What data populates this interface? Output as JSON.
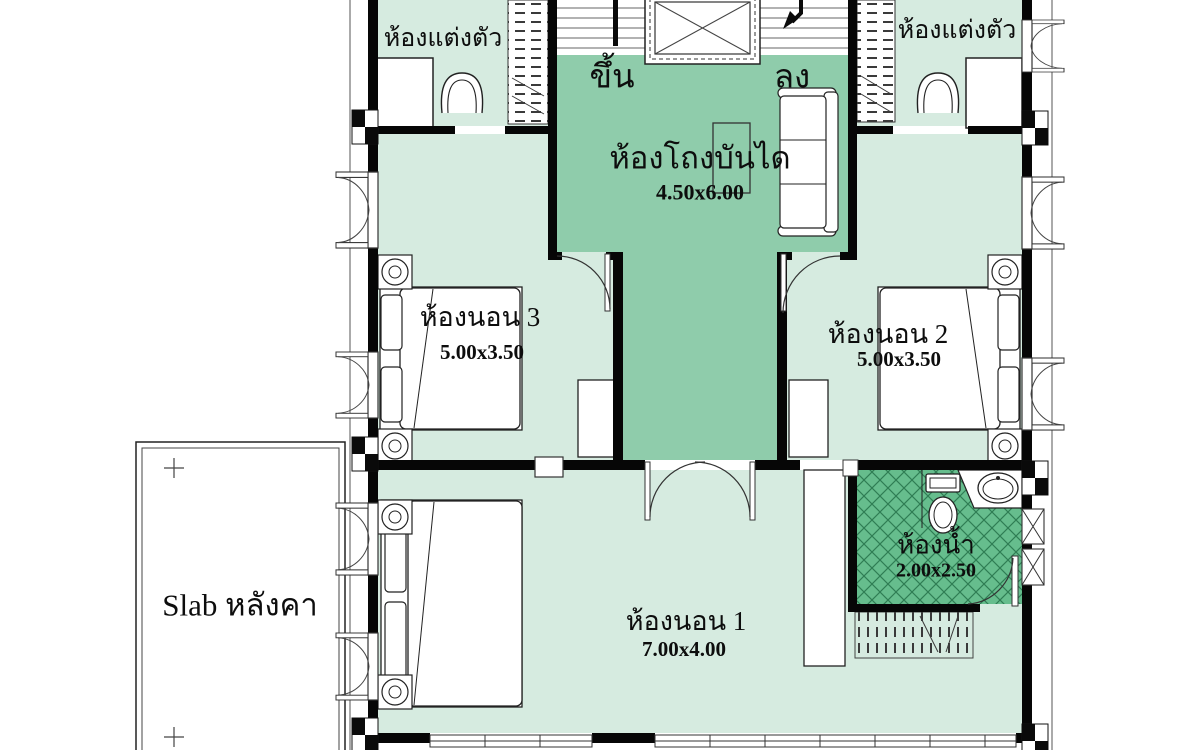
{
  "colors": {
    "room_light": "#d6ebe0",
    "hall_green": "#8fccab",
    "bath_green": "#66bd8d",
    "wall": "#060606",
    "hatch_line": "#2f7d54"
  },
  "stair_hall": {
    "label": "ห้องโถงบันได",
    "size": "4.50x6.00",
    "up_label": "ขึ้น",
    "down_label": "ลง"
  },
  "dressing_left": {
    "label": "ห้องแต่งตัว"
  },
  "dressing_right": {
    "label": "ห้องแต่งตัว"
  },
  "bedroom3": {
    "label": "ห้องนอน 3",
    "size": "5.00x3.50"
  },
  "bedroom2": {
    "label": "ห้องนอน 2",
    "size": "5.00x3.50"
  },
  "bedroom1": {
    "label": "ห้องนอน 1",
    "size": "7.00x4.00"
  },
  "bathroom": {
    "label": "ห้องน้ำ",
    "size": "2.00x2.50"
  },
  "roof_slab": {
    "label": "Slab หลังคา"
  }
}
